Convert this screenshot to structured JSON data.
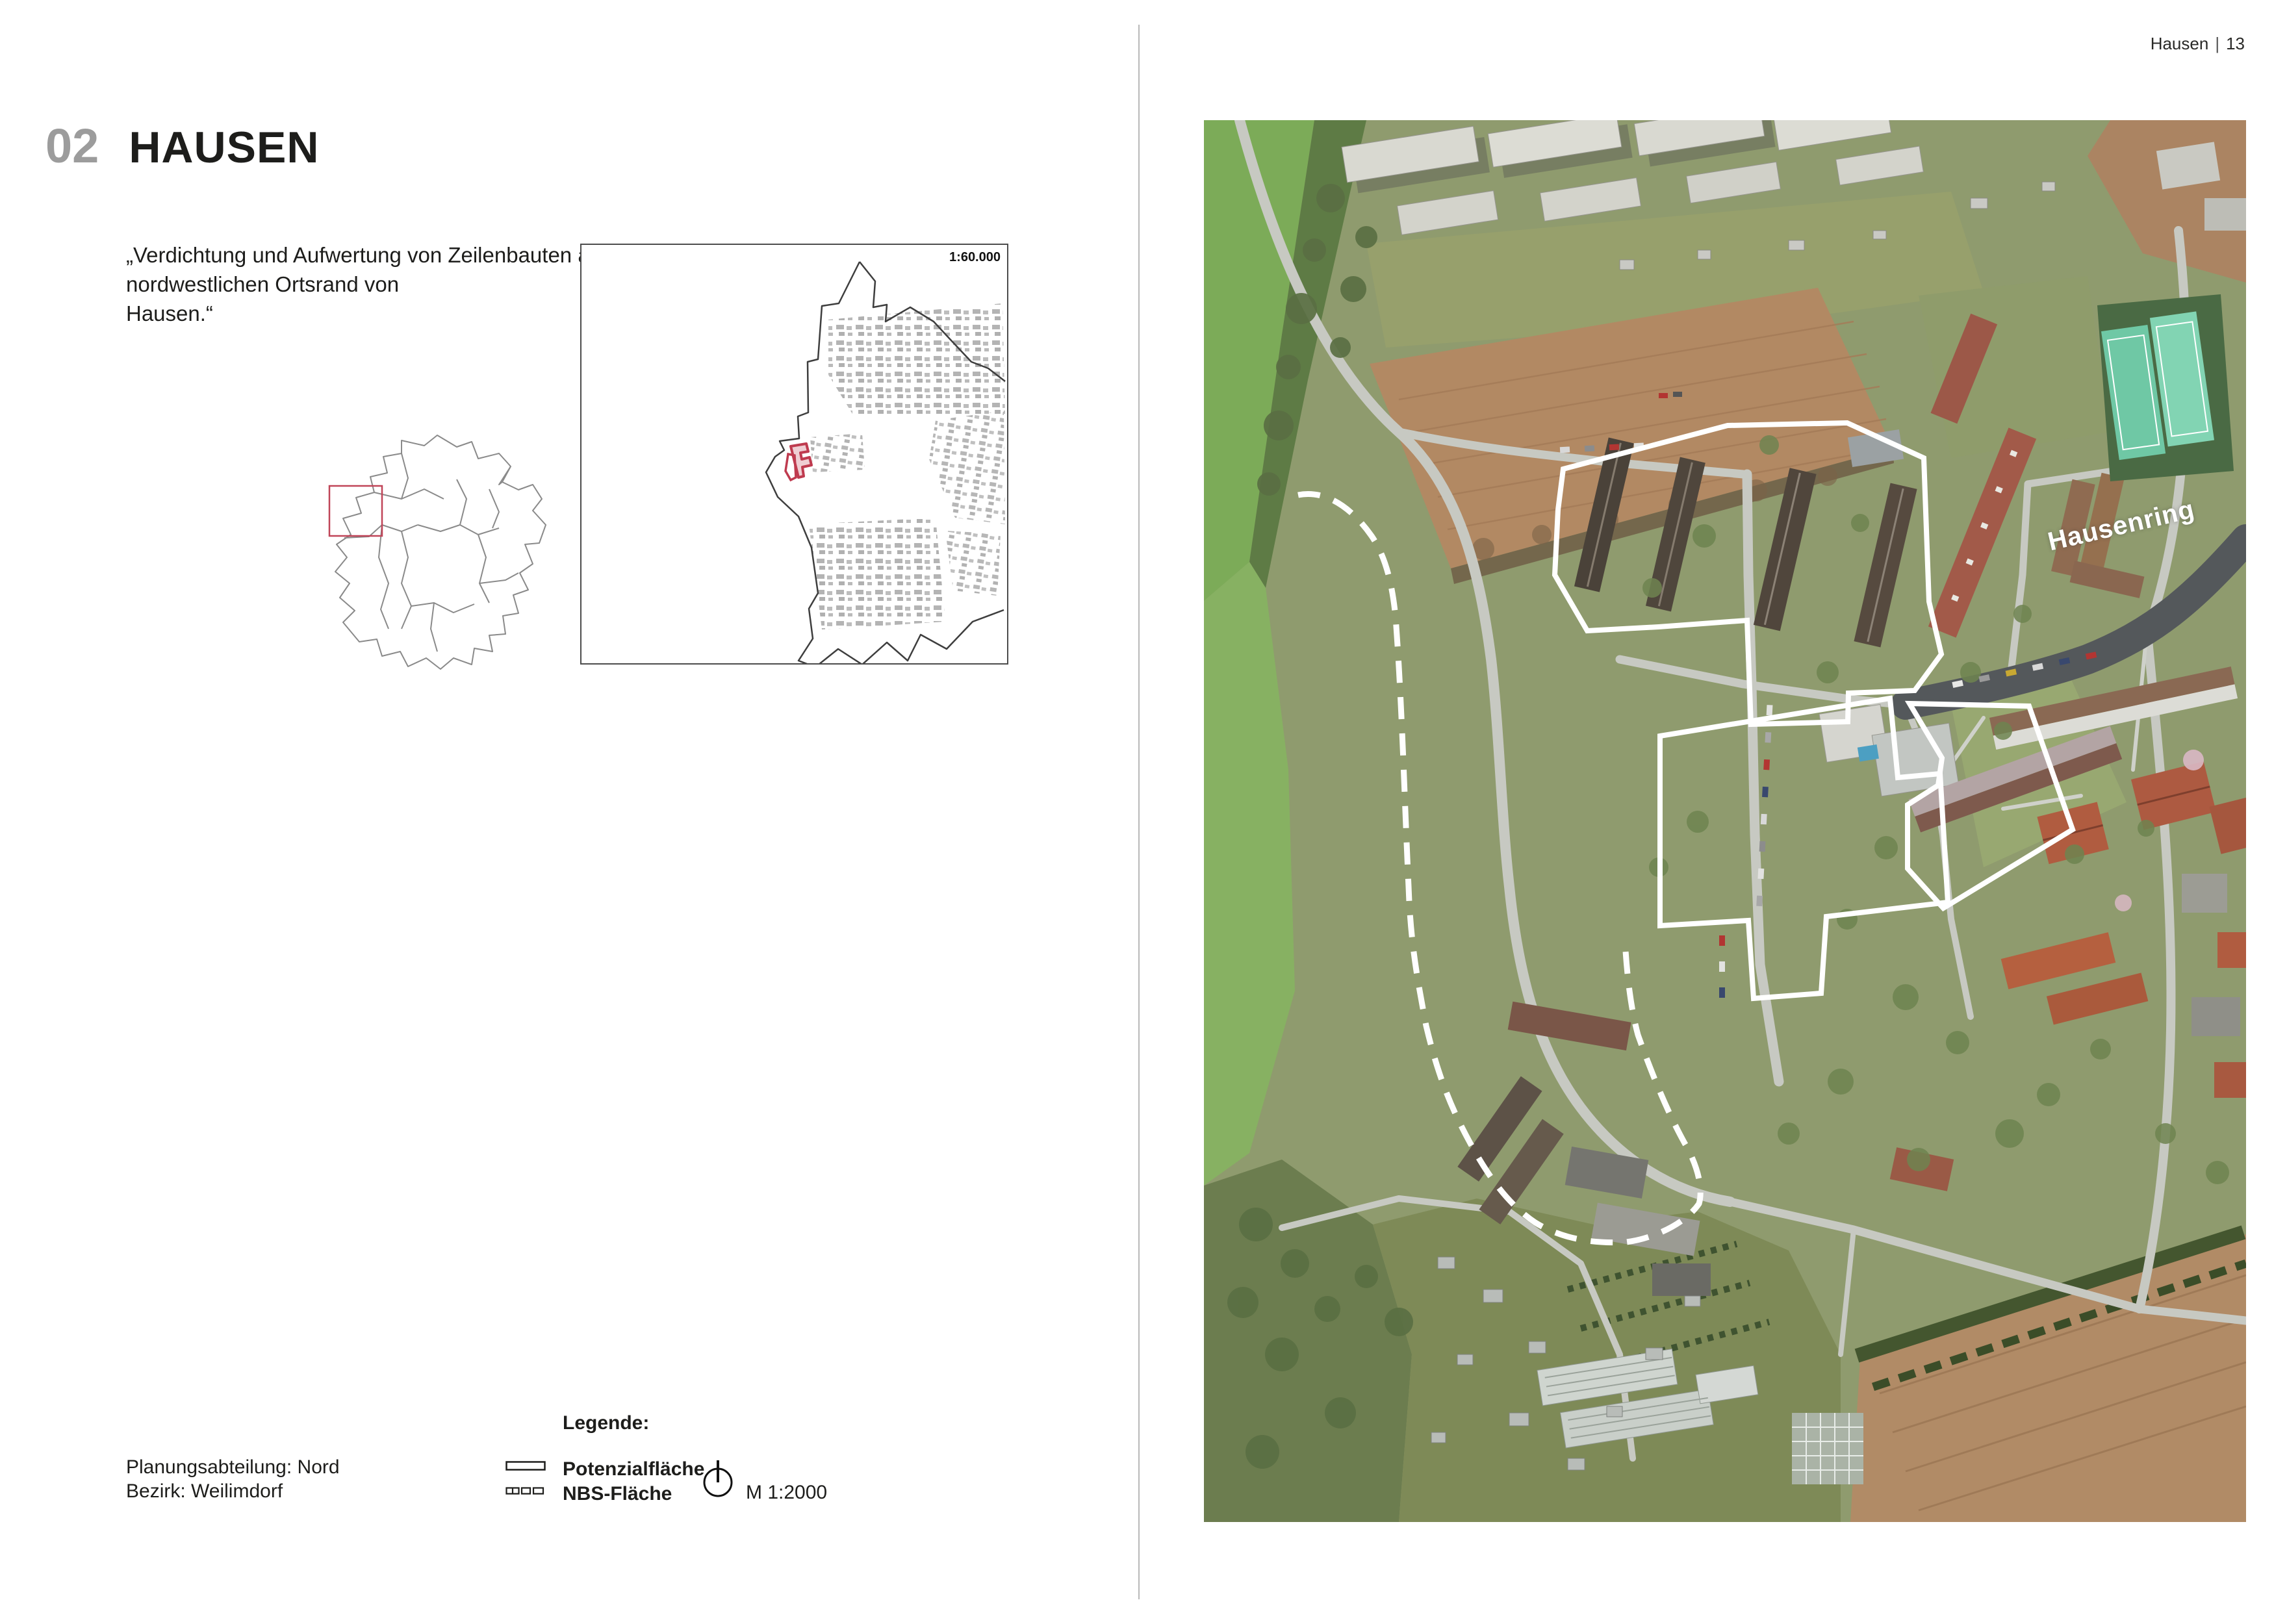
{
  "page": {
    "header_left_part": "Hausen",
    "header_page_number": "13",
    "header_separator": "|"
  },
  "chapter": {
    "number": "02",
    "title": "HAUSEN"
  },
  "quote": {
    "line1_words": "„Verdichtung und Aufwertung von Zeilenbauten am",
    "line2": "nordwestlichen Ortsrand von Hausen.“"
  },
  "overview_map": {
    "scale_label": "1:60.000",
    "highlight_color": "#bf3b4f"
  },
  "legend": {
    "heading": "Legende:",
    "items": [
      {
        "id": "potenzialflaeche",
        "label": "Potenzialfläche",
        "symbol": "solid-outline-rect"
      },
      {
        "id": "nbs-flaeche",
        "label": "NBS-Fläche",
        "symbol": "dashed-outline-rect"
      }
    ],
    "north_icon": "north-arrow-circle",
    "scale_label": "M 1:2000"
  },
  "footer": {
    "department": "Planungsabteilung: Nord",
    "district": "Bezirk: Weilimdorf"
  },
  "aerial": {
    "street_label": "Hausenring",
    "boundary_solid_color": "#ffffff",
    "boundary_dashed_color": "#ffffff"
  }
}
